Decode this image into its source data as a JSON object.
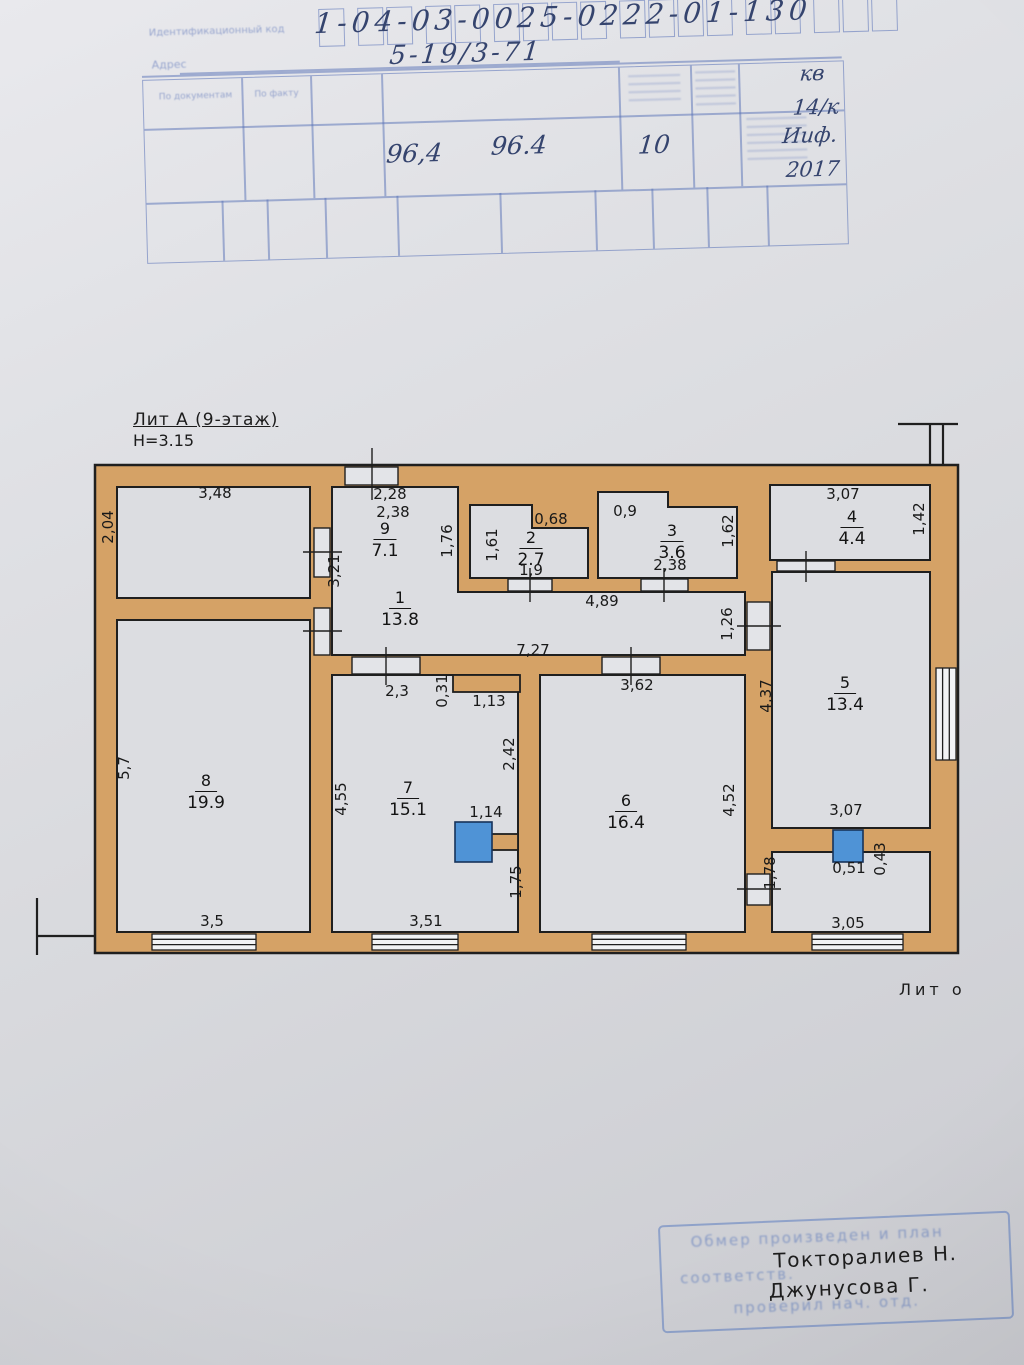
{
  "header_stamp": {
    "id_label": "Идентификационный код",
    "id_code": "1-04-03-0025-0222-01-130",
    "address_label": "Адрес",
    "address_value": "5-19/3-71",
    "col1_header": "По документам",
    "col2_header": "По факту",
    "hand_right_1": "кв",
    "hand_right_2": "14/к",
    "area_by_docs": "96,4",
    "area_by_fact": "96.4",
    "floor_value": "10",
    "hand_month": "Ииф.",
    "hand_year": "2017"
  },
  "plan": {
    "title": "Лит А (9-этаж)",
    "height_label": "Н=3.15",
    "liter_label": "Лит о",
    "rooms": [
      {
        "num": "1",
        "area": "13.8"
      },
      {
        "num": "2",
        "area": "2.7"
      },
      {
        "num": "3",
        "area": "3.6"
      },
      {
        "num": "4",
        "area": "4.4"
      },
      {
        "num": "5",
        "area": "13.4"
      },
      {
        "num": "6",
        "area": "16.4"
      },
      {
        "num": "7",
        "area": "15.1"
      },
      {
        "num": "8",
        "area": "19.9"
      },
      {
        "num": "9",
        "area": "7.1"
      }
    ],
    "dims": [
      "3,48",
      "2,04",
      "2,28",
      "2,38",
      "1,76",
      "1,61",
      "0,68",
      "1,9",
      "0,9",
      "1,62",
      "2,38",
      "3,07",
      "1,42",
      "3,21",
      "4,89",
      "1,26",
      "7,27",
      "2,3",
      "0,31",
      "1,13",
      "2,42",
      "4,55",
      "3,62",
      "4,37",
      "4,52",
      "1,14",
      "1,75",
      "5,7",
      "3,5",
      "3,51",
      "1,78",
      "0,51",
      "0,43",
      "3,05",
      "3,07"
    ],
    "wall_color": "#d5a266",
    "shaft_color": "#4f93d6"
  },
  "footer_stamp": {
    "faint_line_1": "Обмер произведен и план",
    "faint_line_2": "соответств.",
    "faint_line_3": "проверил нач. отд.",
    "name_1": "Токторалиев Н.",
    "name_2": "Джунусова Г."
  }
}
